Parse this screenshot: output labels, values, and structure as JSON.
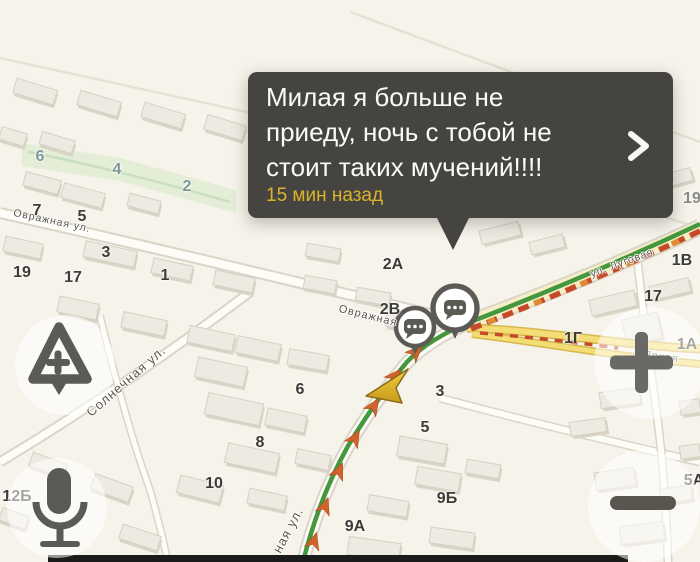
{
  "colors": {
    "map_bg": "#f6f3ea",
    "popup_bg": "#454440",
    "popup_text": "#fafaf7",
    "popup_time": "#dcb32a",
    "route_green": "#44973c",
    "jam_red": "#c6492a",
    "jam_orange": "#dd8c33",
    "yellow_road": "#f4dd74",
    "label_teal": "#7e9a98",
    "icon_gray": "#5c5a55"
  },
  "popup": {
    "line1": "Милая я больше не",
    "line2": "приеду, ночь с тобой не",
    "line3": "стоит таких мучений!!!!",
    "time": "15 мин назад"
  },
  "map": {
    "street_labels": [
      {
        "text": "Овражная ул.",
        "x": 52,
        "y": 221,
        "rot": 12,
        "size": 10.5
      },
      {
        "text": "Овражная",
        "x": 368,
        "y": 316,
        "rot": 14,
        "size": 11
      },
      {
        "text": "Солнечная ул.",
        "x": 126,
        "y": 381,
        "rot": -41,
        "size": 13
      },
      {
        "text": "ная ул.",
        "x": 288,
        "y": 530,
        "rot": -62,
        "size": 13
      },
      {
        "text": "ул. Луговая",
        "x": 622,
        "y": 263,
        "rot": -20,
        "size": 10.5
      },
      {
        "text": "Яркая",
        "x": 661,
        "y": 357,
        "rot": 7,
        "size": 11
      }
    ],
    "house_numbers": [
      {
        "t": "19",
        "x": 22,
        "y": 273
      },
      {
        "t": "17",
        "x": 73,
        "y": 278
      },
      {
        "t": "3",
        "x": 106,
        "y": 253
      },
      {
        "t": "1",
        "x": 165,
        "y": 276
      },
      {
        "t": "7",
        "x": 37,
        "y": 211
      },
      {
        "t": "5",
        "x": 82,
        "y": 217
      },
      {
        "t": "6",
        "x": 40,
        "y": 157,
        "c": "teal"
      },
      {
        "t": "4",
        "x": 117,
        "y": 170,
        "c": "teal"
      },
      {
        "t": "2",
        "x": 187,
        "y": 187,
        "c": "teal"
      },
      {
        "t": "2А",
        "x": 393,
        "y": 265
      },
      {
        "t": "2В",
        "x": 390,
        "y": 310
      },
      {
        "t": "3",
        "x": 440,
        "y": 392
      },
      {
        "t": "6",
        "x": 300,
        "y": 390
      },
      {
        "t": "8",
        "x": 260,
        "y": 443
      },
      {
        "t": "10",
        "x": 214,
        "y": 484
      },
      {
        "t": "5",
        "x": 425,
        "y": 428
      },
      {
        "t": "9Б",
        "x": 447,
        "y": 499
      },
      {
        "t": "9А",
        "x": 355,
        "y": 527
      },
      {
        "t": "12Б",
        "x": 17,
        "y": 497
      },
      {
        "t": "1В",
        "x": 682,
        "y": 261
      },
      {
        "t": "17",
        "x": 653,
        "y": 297
      },
      {
        "t": "1Г",
        "x": 573,
        "y": 339
      },
      {
        "t": "1А",
        "x": 687,
        "y": 345
      },
      {
        "t": "5А",
        "x": 694,
        "y": 481
      },
      {
        "t": "19",
        "x": 692,
        "y": 199,
        "c": "gray"
      }
    ],
    "park": {
      "points": "22,143 120,158 236,190 236,213 120,181 22,166",
      "stream": "M28,152 Q120,170 230,202"
    },
    "roads": {
      "thin1": "M0,58 L520,172",
      "thin2": "M350,12 L700,142",
      "thin3": "M520,172 L700,228",
      "ovr": "M0,213 Q200,258 470,324",
      "soln": "M0,462 Q120,390 250,292",
      "cross": "M100,316 Q128,430 150,490 Q160,525 168,562",
      "band": "M440,398 Q560,430 700,462",
      "right_rd": "M637,256 Q645,330 655,400 Q665,470 668,562",
      "main_ne": "M700,227 Q585,280 470,322",
      "south": "M470,322 Q425,342 404,366 Q372,406 349,445 Q320,496 303,562",
      "y1": "M467,328 C540,330 620,345 700,349",
      "y2": "M472,334 C540,342 610,356 700,364"
    },
    "traffic": {
      "route": "M700,224 Q580,280 465,324 Q420,344 402,368 Q372,406 348,446 Q319,498 303,562",
      "jam_upper": "M700,231 Q585,285 468,330",
      "jam_yellow": "M480,333 C540,338 580,343 618,348",
      "arrows": [
        [
          314,
          541,
          17
        ],
        [
          325,
          506,
          20
        ],
        [
          339,
          471,
          24
        ],
        [
          355,
          438,
          30
        ],
        [
          374,
          406,
          34
        ],
        [
          395,
          376,
          40
        ],
        [
          416,
          352,
          45
        ]
      ]
    },
    "markers": [
      {
        "x": 455,
        "y": 308,
        "r": 22
      },
      {
        "x": 415,
        "y": 327,
        "r": 19
      }
    ],
    "buildings": [
      [
        14,
        84,
        42,
        15,
        17
      ],
      [
        78,
        96,
        42,
        15,
        17
      ],
      [
        142,
        108,
        42,
        15,
        17
      ],
      [
        205,
        120,
        40,
        15,
        17
      ],
      [
        0,
        130,
        26,
        13,
        17
      ],
      [
        40,
        136,
        34,
        13,
        17
      ],
      [
        24,
        176,
        36,
        14,
        15
      ],
      [
        62,
        188,
        42,
        15,
        15
      ],
      [
        128,
        197,
        32,
        13,
        15
      ],
      [
        4,
        240,
        38,
        15,
        12
      ],
      [
        84,
        246,
        52,
        16,
        12
      ],
      [
        152,
        262,
        40,
        15,
        12
      ],
      [
        214,
        274,
        40,
        15,
        12
      ],
      [
        58,
        300,
        40,
        16,
        12
      ],
      [
        122,
        316,
        44,
        16,
        12
      ],
      [
        188,
        330,
        46,
        17,
        12
      ],
      [
        236,
        340,
        44,
        17,
        12
      ],
      [
        288,
        352,
        40,
        16,
        10
      ],
      [
        196,
        362,
        50,
        20,
        12
      ],
      [
        206,
        398,
        56,
        22,
        12
      ],
      [
        266,
        412,
        40,
        17,
        12
      ],
      [
        226,
        448,
        52,
        20,
        12
      ],
      [
        296,
        452,
        34,
        15,
        12
      ],
      [
        178,
        480,
        44,
        18,
        14
      ],
      [
        248,
        492,
        38,
        15,
        12
      ],
      [
        30,
        458,
        36,
        14,
        20
      ],
      [
        92,
        480,
        40,
        16,
        20
      ],
      [
        0,
        512,
        28,
        13,
        20
      ],
      [
        120,
        530,
        40,
        15,
        18
      ],
      [
        306,
        246,
        34,
        13,
        10
      ],
      [
        304,
        278,
        32,
        13,
        10
      ],
      [
        356,
        290,
        34,
        13,
        10
      ],
      [
        386,
        315,
        36,
        14,
        10
      ],
      [
        398,
        440,
        48,
        20,
        10
      ],
      [
        416,
        470,
        44,
        18,
        10
      ],
      [
        368,
        498,
        40,
        16,
        10
      ],
      [
        348,
        540,
        52,
        18,
        8
      ],
      [
        430,
        530,
        44,
        16,
        8
      ],
      [
        466,
        462,
        34,
        14,
        10
      ],
      [
        566,
        196,
        30,
        12,
        -15
      ],
      [
        600,
        184,
        40,
        14,
        -15
      ],
      [
        656,
        172,
        36,
        13,
        -15
      ],
      [
        590,
        295,
        46,
        16,
        -13
      ],
      [
        650,
        282,
        40,
        14,
        -13
      ],
      [
        624,
        316,
        36,
        26,
        -13
      ],
      [
        600,
        390,
        40,
        16,
        -8
      ],
      [
        570,
        420,
        36,
        14,
        -8
      ],
      [
        680,
        400,
        20,
        14,
        -8
      ],
      [
        595,
        470,
        40,
        18,
        -8
      ],
      [
        660,
        487,
        32,
        15,
        -8
      ],
      [
        620,
        524,
        44,
        18,
        -8
      ],
      [
        680,
        445,
        20,
        13,
        -8
      ],
      [
        480,
        226,
        40,
        14,
        -14
      ],
      [
        530,
        238,
        34,
        13,
        -14
      ]
    ]
  }
}
